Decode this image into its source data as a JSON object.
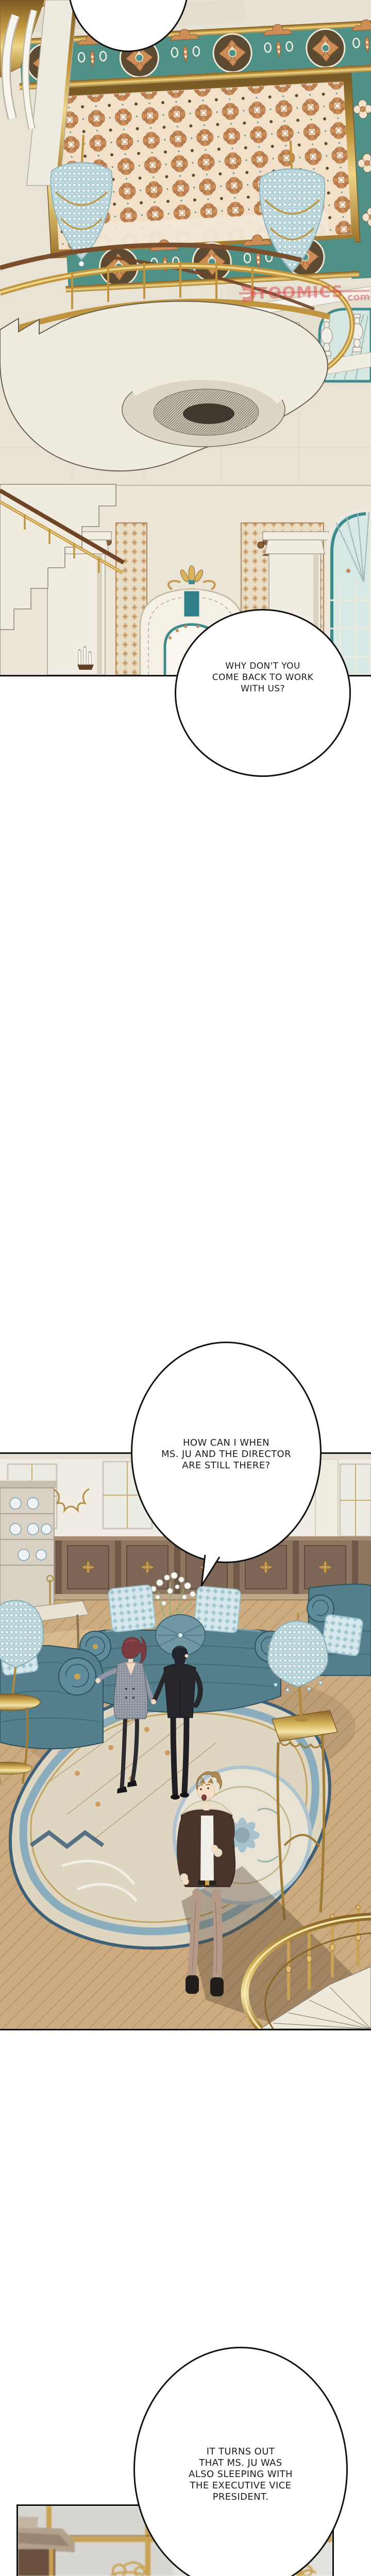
{
  "speech": {
    "bubble1": {
      "lines": [
        "WHY DON'T YOU",
        "COME BACK TO WORK",
        "WITH US?"
      ]
    },
    "bubble2": {
      "lines": [
        "HOW CAN I WHEN",
        "MS. JU AND THE DIRECTOR",
        "ARE STILL THERE?"
      ]
    },
    "bubble3": {
      "lines": [
        "IT TURNS OUT",
        "THAT MS. JU WAS",
        "ALSO SLEEPING WITH",
        "THE EXECUTIVE VICE",
        "PRESIDENT."
      ]
    }
  },
  "watermark": {
    "brand": "TOOMICS",
    "domain_suffix": ".com"
  },
  "palette": {
    "ink": "#111111",
    "ceiling_teal": "#4F9187",
    "ornament_orange": "#CD8D57",
    "gold": "#C1953F",
    "marble": "#E9E3D6",
    "sofa_teal": "#54808E",
    "pillow_blue": "#D7E8EC",
    "wainscot_wood": "#8D7560",
    "floor_wood": "#CDAB80",
    "rug_blue": "#7FA8BD",
    "hair_auburn": "#7A3B41",
    "jacket_brown": "#4A352C",
    "watermark_pink": "#DB5555"
  }
}
